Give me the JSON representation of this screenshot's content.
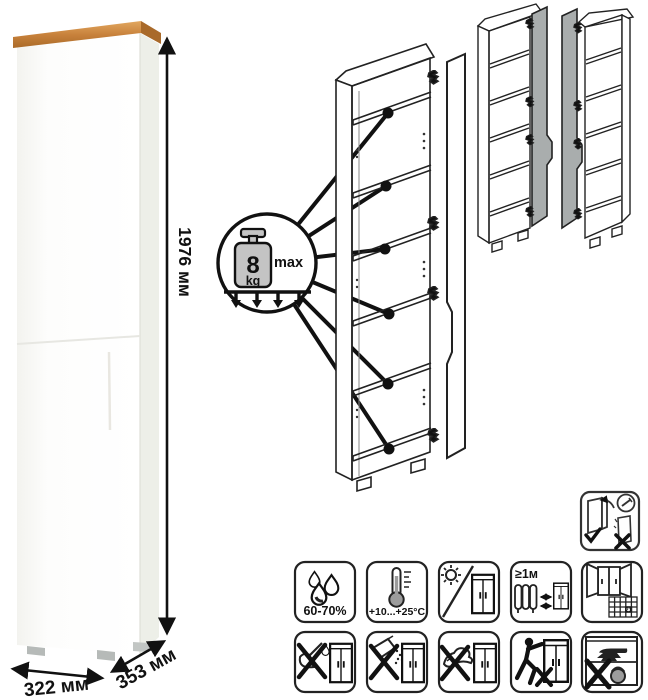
{
  "dimensions": {
    "height": "1976 мм",
    "width": "322 мм",
    "depth": "353 мм"
  },
  "load_limit": {
    "value": "8",
    "unit": "kg",
    "qualifier": "max"
  },
  "care_labels": {
    "humidity": "60-70%",
    "temperature": "+10...+25°C",
    "min_distance": "≥1м",
    "calendar_day": "21"
  },
  "colors": {
    "wood_top": "#c8823c",
    "wood_top_dark": "#a96a2a",
    "cabinet_front": "#fcfcfa",
    "cabinet_side": "#edefe8",
    "door_gray": "#a9adad",
    "weight_fill": "#c4c4c4",
    "line_black": "#1a1a1a"
  },
  "icons": {
    "row1": [
      "humidity-60-70",
      "temperature-range",
      "avoid-direct-sunlight",
      "keep-1m-from-heat",
      "ventilate-room-calendar"
    ],
    "row2": [
      "no-aggressive-liquids",
      "no-abrasive-powders",
      "no-wet-cloth",
      "do-not-drag",
      "no-heavy-objects"
    ],
    "standalone": [
      "anchor-to-wall"
    ]
  }
}
